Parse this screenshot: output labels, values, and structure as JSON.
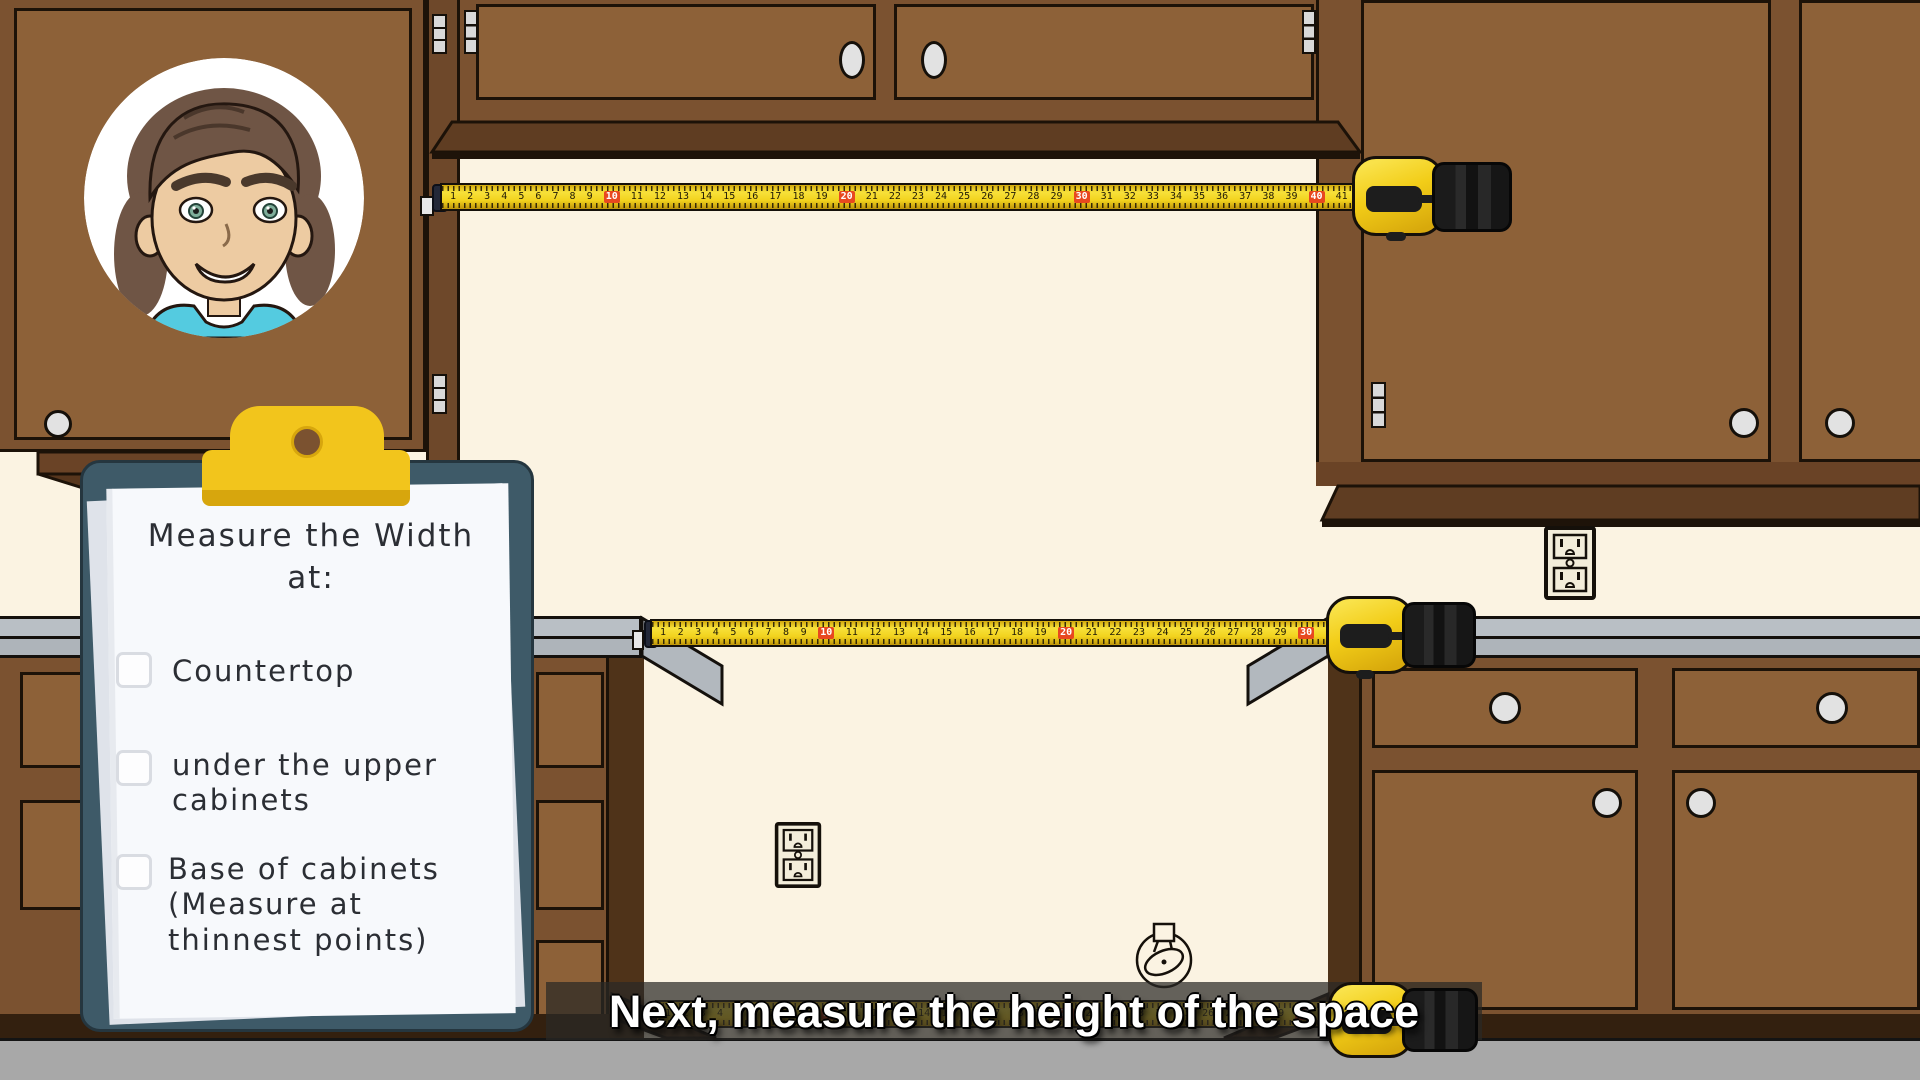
{
  "clipboard": {
    "title_lines": [
      "Measure the Width",
      "at:"
    ],
    "items": [
      {
        "label": "Countertop",
        "checked": false
      },
      {
        "label": "under the upper cabinets",
        "checked": false
      },
      {
        "label": "Base of cabinets (Measure at thinnest points)",
        "checked": false
      }
    ]
  },
  "caption": {
    "text": "Next, measure the height of the space"
  },
  "tapes": {
    "top": {
      "start": 1,
      "end": 41,
      "highlight_every": 10
    },
    "middle": {
      "start": 1,
      "end": 31,
      "highlight_every": 10
    },
    "bottom": {
      "start": 1,
      "end": 31,
      "highlight_every": 10
    }
  },
  "colors": {
    "wall": "#fbf3e2",
    "cabinet_frame": "#7b5230",
    "cabinet_door": "#8d6138",
    "cabinet_shadow": "#5f3d22",
    "countertop": "#b7bdc3",
    "floor": "#a8a8a8",
    "tape_yellow": "#f2d21d",
    "tape_red_mark": "#e8481f",
    "clipboard_board": "#3e5a68",
    "clip_yellow": "#f2c51c",
    "paper": "#f7f9fc",
    "ink": "#2b2e34",
    "caption_text": "#ffffff"
  }
}
